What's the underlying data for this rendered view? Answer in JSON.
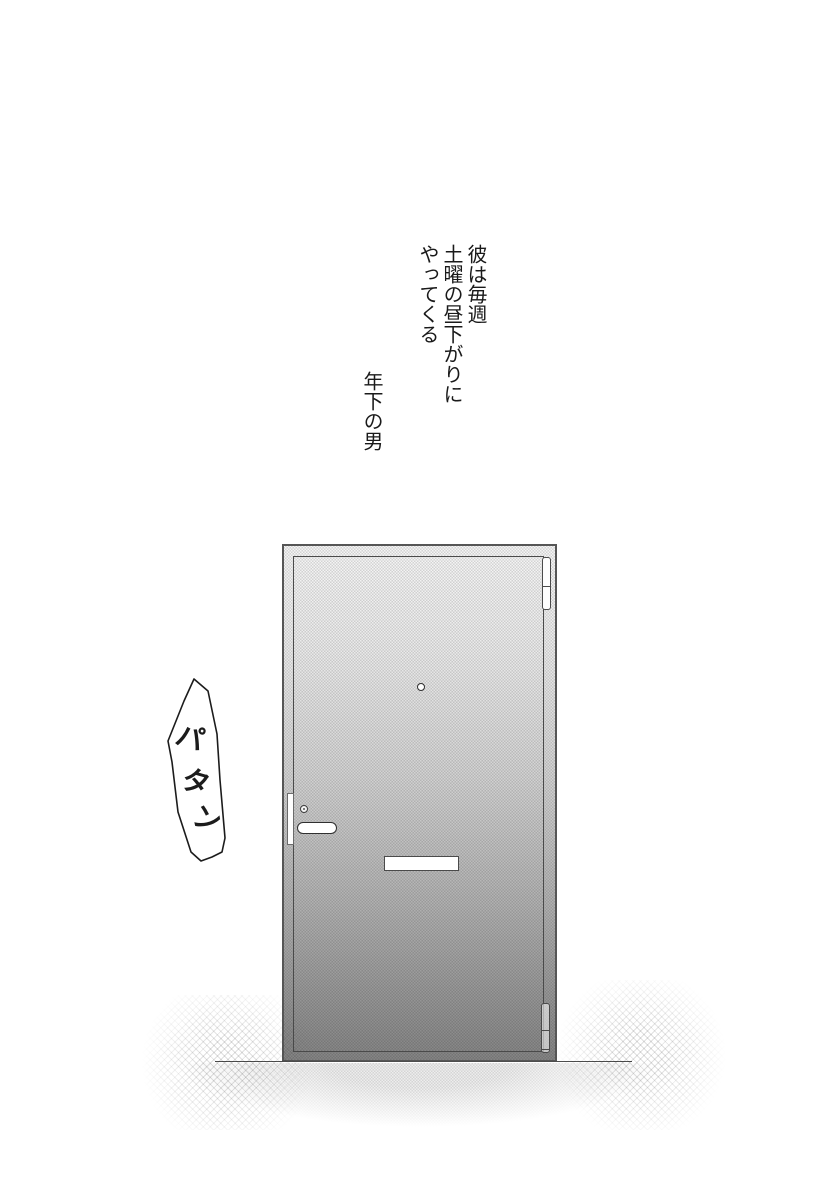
{
  "page": {
    "background": "#ffffff",
    "ink_color": "#1a1a1a"
  },
  "captions": {
    "intro_lines": [
      "彼は毎週",
      "土曜の昼下がりに",
      "やってくる"
    ],
    "title": "年下の男"
  },
  "sfx": {
    "text": "パタン",
    "chars": [
      "パ",
      "タ",
      "ン"
    ]
  },
  "door": {
    "frame_border_color": "#565656",
    "panel_line_color": "#4a4a4a",
    "tone_top_color": "#f6f6f6",
    "tone_bottom_color": "#848484",
    "hardware_fill_color": "#ffffff",
    "floor_line_color": "#4d4d4d"
  }
}
